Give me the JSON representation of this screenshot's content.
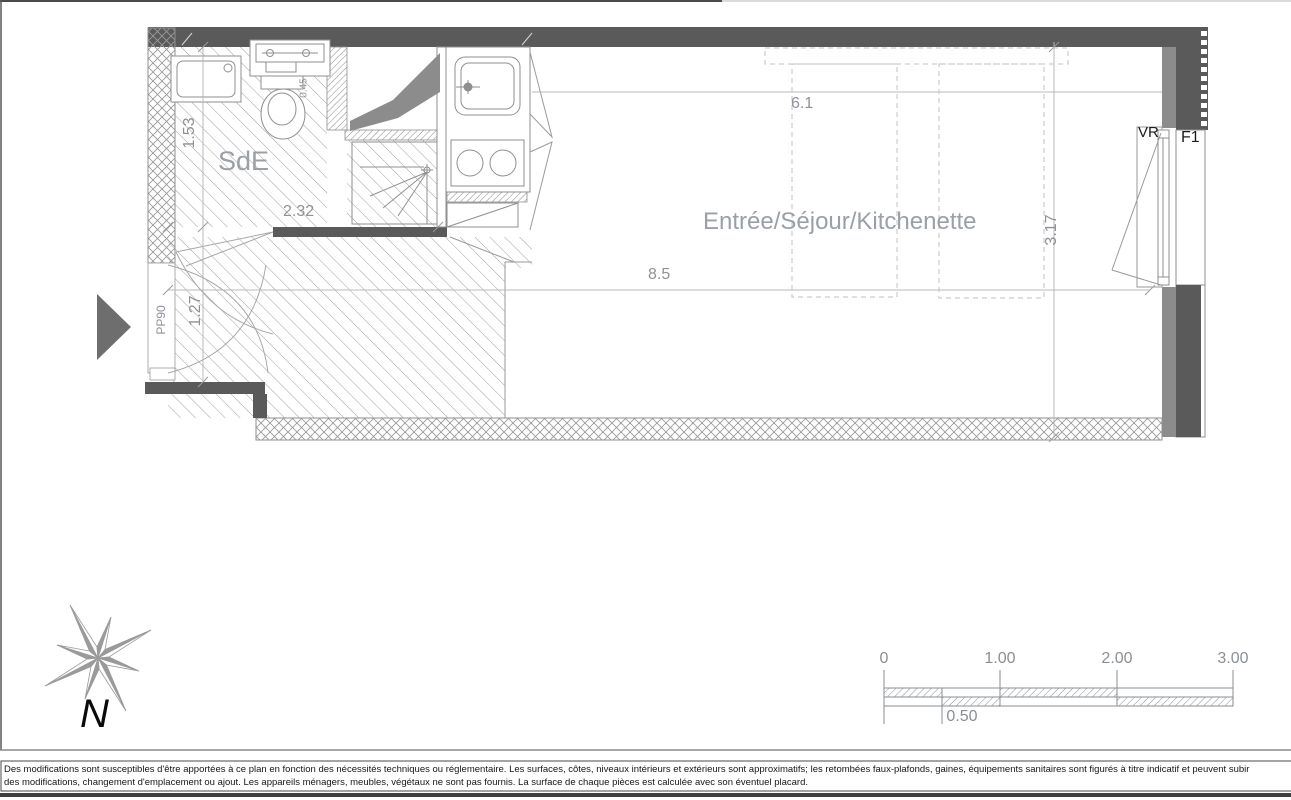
{
  "plan": {
    "rooms": {
      "bathroom": "SdE",
      "main": "Entrée/Séjour/Kitchenette"
    },
    "dimensions": {
      "bath_width": "1.53",
      "bath_length": "2.32",
      "toilet_clearance": "0.45",
      "entry_width": "1.27",
      "entry_door": "PP90",
      "living_length": "6.1",
      "total_length": "8.5",
      "room_depth": "3.17"
    },
    "window": {
      "shutter": "VR",
      "label": "F1"
    }
  },
  "compass": {
    "label": "N"
  },
  "scale_bar": {
    "ticks": [
      "0",
      "1.00",
      "2.00",
      "3.00"
    ],
    "sub_tick": "0.50"
  },
  "disclaimer": {
    "line1": "Des modifications sont susceptibles d'être apportées à ce plan en fonction des nécessités techniques ou réglementaire. Les surfaces, côtes, niveaux intérieurs et extérieurs sont approximatifs; les retombées faux-plafonds, gaines, équipements sanitaires sont figurés à titre indicatif et peuvent subir",
    "line2": "des modifications, changement d'emplacement ou ajout. Les appareils ménagers, meubles, végétaux ne sont pas fournis. La surface de chaque pièces est calculée avec son éventuel placard."
  },
  "colors": {
    "wall": "#5a5a5a",
    "window_reveal": "#8c8c8c",
    "hatch": "#a0a0a0",
    "dimension_text": "#8d9298",
    "room_label": "#9aa0a6"
  }
}
